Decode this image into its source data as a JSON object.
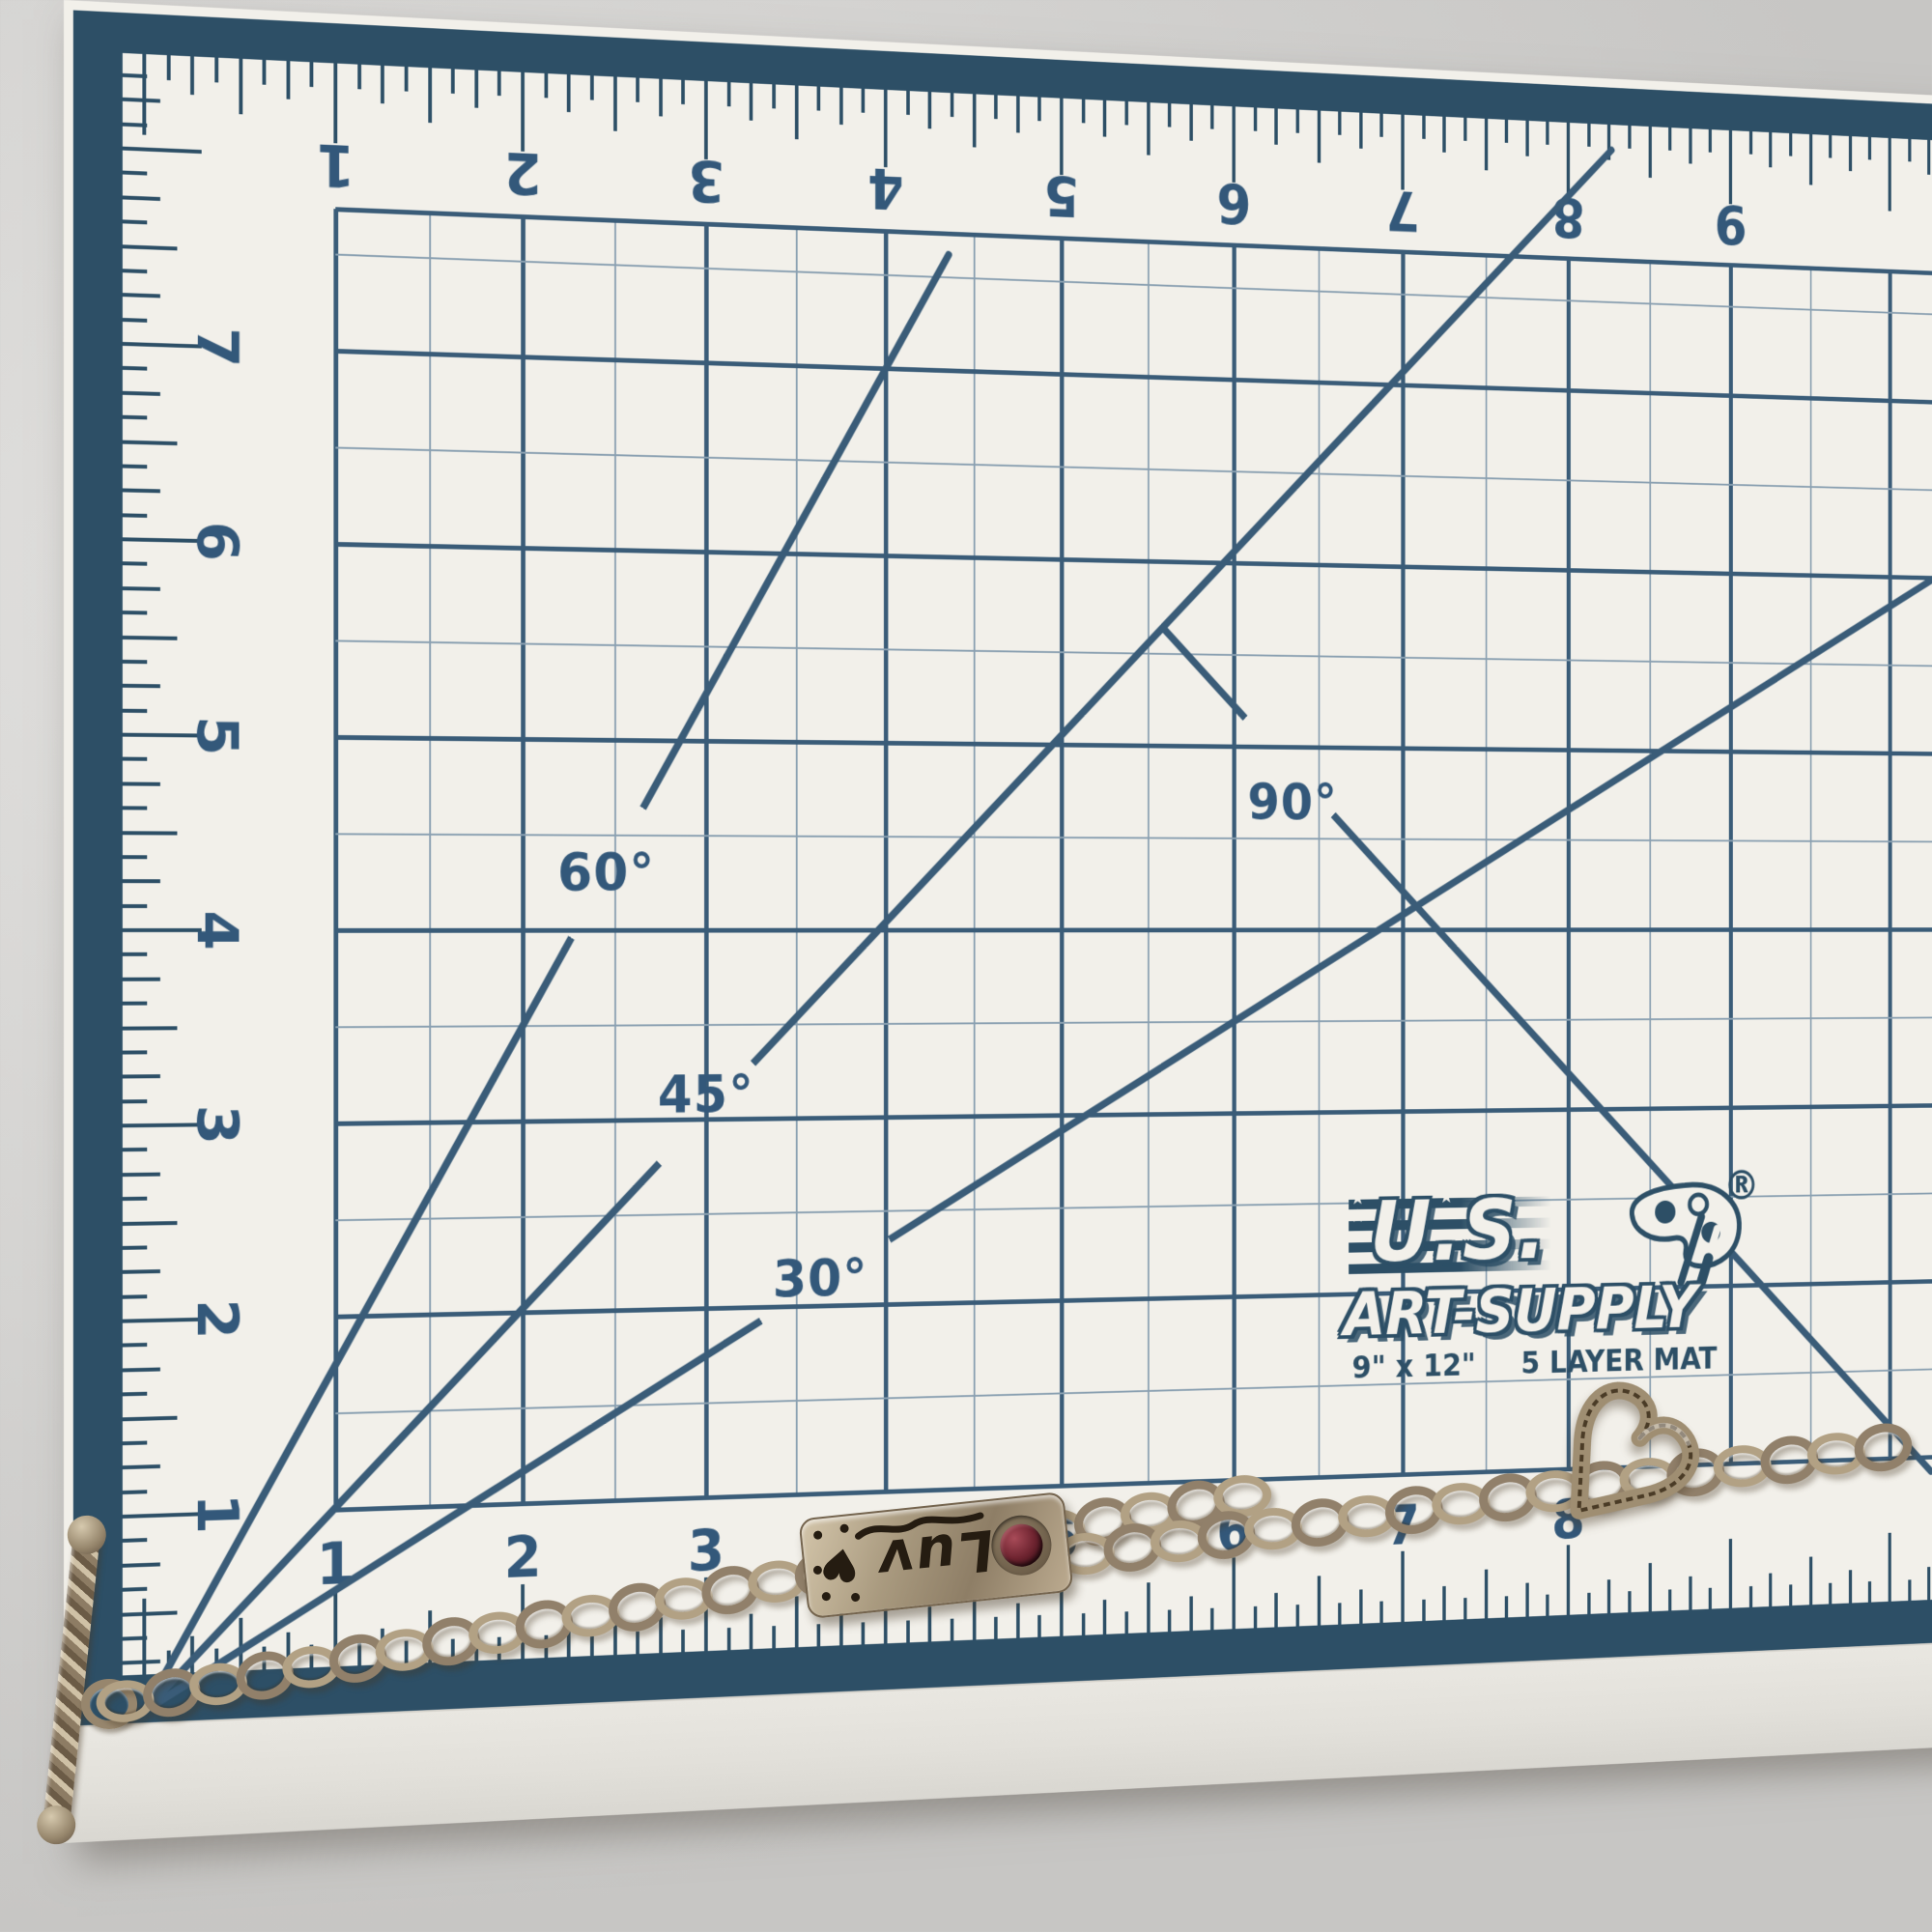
{
  "scene": {
    "table_color": "#d4d3d1",
    "mat_color": "#f2f0ea",
    "band_color": "#2d4f66",
    "line_color": "#3a5c78",
    "thin_line_color": "#8aa0b1",
    "label_color": "#33587a"
  },
  "rulers": {
    "top_numbers": [
      "1",
      "2",
      "3",
      "4",
      "5",
      "6",
      "7",
      "8",
      "9"
    ],
    "left_numbers": [
      "7",
      "6",
      "5",
      "4",
      "3",
      "2",
      "1"
    ],
    "bottom_numbers": [
      "1",
      "2",
      "3",
      "4",
      "5",
      "6",
      "7",
      "8"
    ]
  },
  "angles": {
    "deg30": "30°",
    "deg45": "45°",
    "deg60": "60°",
    "deg90": "90°"
  },
  "logo": {
    "brand_top": "U.S.",
    "brand_bottom": "ART-SUPPLY",
    "registered": "®",
    "stars": "★ ★ ★ ★ ★",
    "size_label": "9\" x 12\"",
    "layer_label": "5 LAYER MAT"
  },
  "bracelet": {
    "plate_text": "Luv",
    "plate_heart": "♥",
    "left_link_count": 25,
    "right_link_count": 18
  }
}
